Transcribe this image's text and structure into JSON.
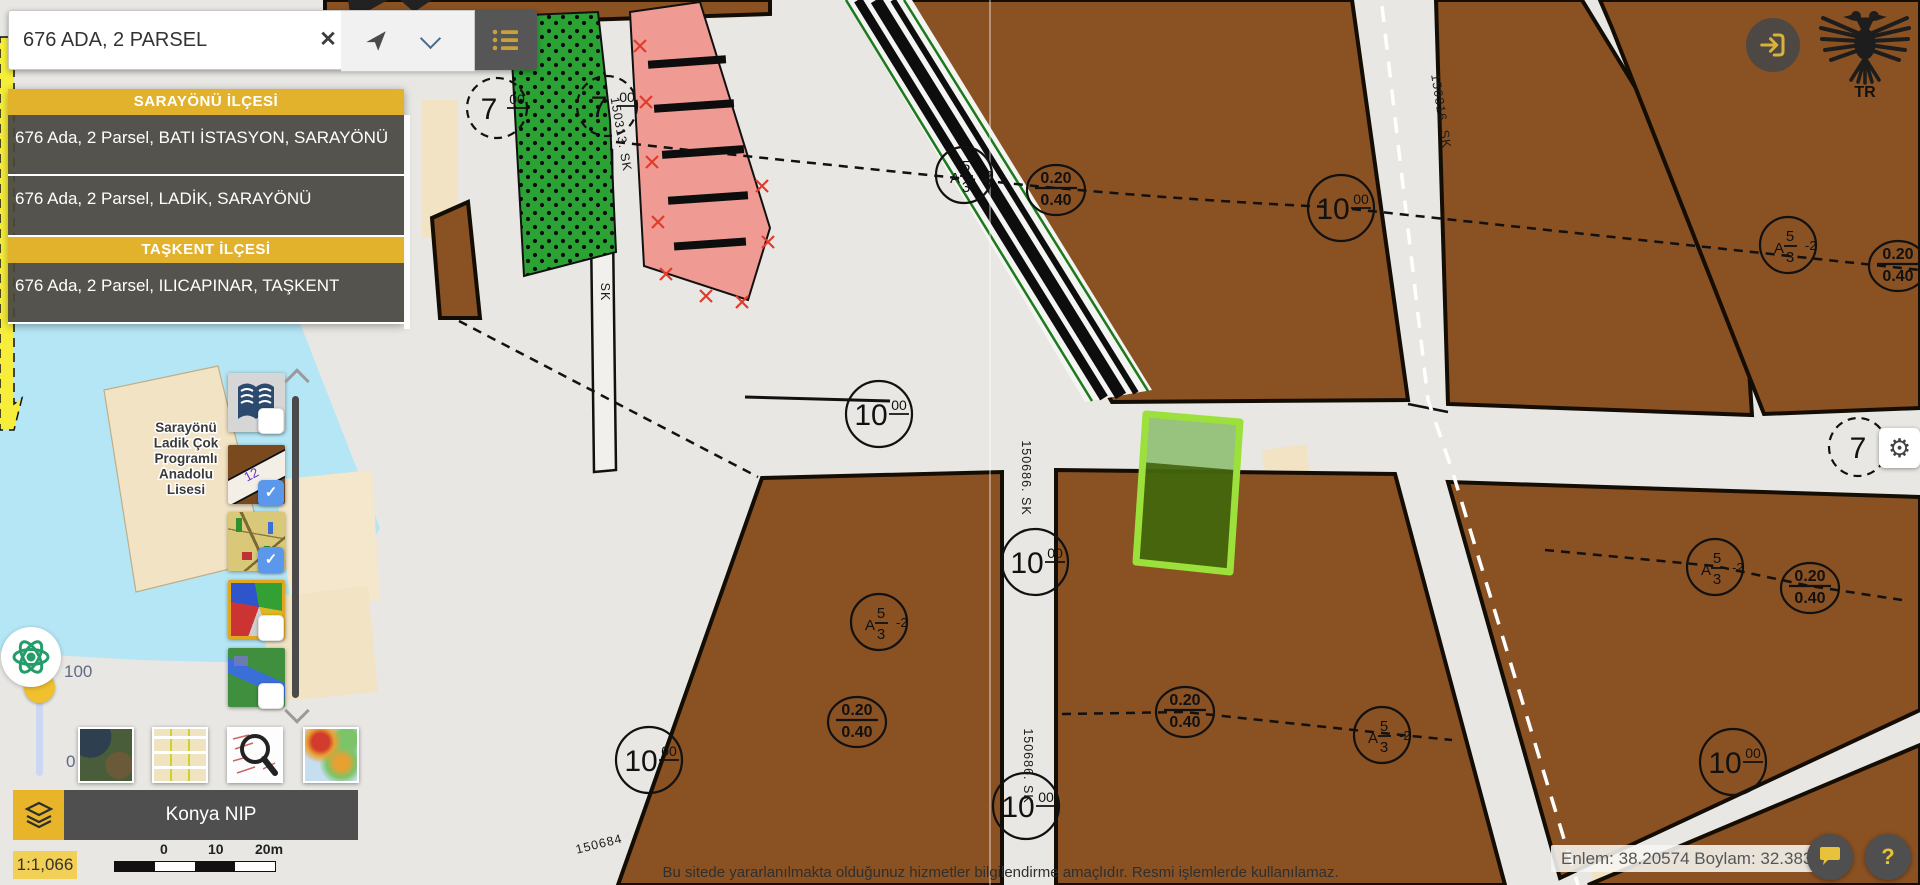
{
  "search": {
    "value": "676 ADA, 2 PARSEL",
    "results": [
      {
        "kind": "header",
        "label": "SARAYÖNÜ İLÇESİ"
      },
      {
        "kind": "item",
        "label": "676 Ada, 2 Parsel, BATI İSTASYON, SARAYÖNÜ"
      },
      {
        "kind": "item",
        "label": "676 Ada, 2 Parsel, LADİK, SARAYÖNÜ"
      },
      {
        "kind": "header",
        "label": "TAŞKENT İLÇESİ"
      },
      {
        "kind": "item",
        "label": "676 Ada, 2 Parsel, ILICAPINAR, TAŞKENT"
      }
    ]
  },
  "layers": {
    "checked": [
      false,
      true,
      true,
      false,
      false
    ]
  },
  "controls": {
    "plan_name": "Konya NIP",
    "scale_text": "1:1,066",
    "scale_ticks": [
      "0",
      "10",
      "20m"
    ],
    "coords": "Enlem: 38.20574 Boylam: 32.38381",
    "slider_max": "100",
    "slider_min": "0",
    "help_label": "?",
    "logo_text": "TR"
  },
  "footer": {
    "disclaimer": "Bu sitede yararlanılmakta olduğunuz hizmetler bilgilendirme amaçlıdır. Resmi işlemlerde kullanılamaz."
  },
  "map": {
    "school_label_lines": [
      "Sarayönü",
      "Ladik Çok",
      "Programlı",
      "Anadolu",
      "Lisesi"
    ],
    "circle_labels": [
      {
        "x": 879,
        "y": 414,
        "main": "10",
        "sup": "00"
      },
      {
        "x": 1035,
        "y": 562,
        "main": "10",
        "sup": "00"
      },
      {
        "x": 649,
        "y": 760,
        "main": "10",
        "sup": "00"
      },
      {
        "x": 1733,
        "y": 762,
        "main": "10",
        "sup": "00"
      },
      {
        "x": 1341,
        "y": 208,
        "main": "10",
        "sup": "00"
      },
      {
        "x": 1026,
        "y": 806,
        "main": "10",
        "sup": "00"
      },
      {
        "x": 497,
        "y": 108,
        "main": "7",
        "sup": "00",
        "dashed": true,
        "r": 30
      },
      {
        "x": 607,
        "y": 106,
        "main": "7",
        "sup": "00",
        "dashed": true,
        "r": 30
      },
      {
        "x": 1858,
        "y": 447,
        "main": "7",
        "sup": "",
        "dashed": true,
        "r": 29
      }
    ],
    "ratio_labels": [
      {
        "x": 1056,
        "y": 190,
        "top": "0.20",
        "bottom": "0.40"
      },
      {
        "x": 1898,
        "y": 266,
        "top": "0.20",
        "bottom": "0.40"
      },
      {
        "x": 857,
        "y": 722,
        "top": "0.20",
        "bottom": "0.40"
      },
      {
        "x": 1185,
        "y": 712,
        "top": "0.20",
        "bottom": "0.40"
      },
      {
        "x": 1810,
        "y": 588,
        "top": "0.20",
        "bottom": "0.40"
      }
    ],
    "zone_labels": [
      {
        "x": 964,
        "y": 175,
        "prefix": "A",
        "top": "5",
        "exp": "-2",
        "bottom": "3"
      },
      {
        "x": 1788,
        "y": 245,
        "prefix": "A",
        "top": "5",
        "exp": "-2",
        "bottom": "3"
      },
      {
        "x": 879,
        "y": 622,
        "prefix": "A",
        "top": "5",
        "exp": "-2",
        "bottom": "3"
      },
      {
        "x": 1382,
        "y": 735,
        "prefix": "A",
        "top": "5",
        "exp": "-2",
        "bottom": "3"
      },
      {
        "x": 1715,
        "y": 567,
        "prefix": "A",
        "top": "5",
        "exp": "-2",
        "bottom": "3"
      }
    ],
    "street_labels": [
      {
        "x": 1437,
        "y": 112,
        "rot": 81,
        "text": "150316. SK"
      },
      {
        "x": 617,
        "y": 135,
        "rot": 80,
        "text": "150313. SK"
      },
      {
        "x": 1022,
        "y": 478,
        "rot": 90,
        "text": "150686. SK"
      },
      {
        "x": 1024,
        "y": 766,
        "rot": 90,
        "text": "150686. SK"
      },
      {
        "x": 600,
        "y": 848,
        "rot": -14,
        "text": "150684"
      },
      {
        "x": 601,
        "y": 292,
        "rot": 90,
        "text": "SK"
      }
    ]
  },
  "colors": {
    "accent_gold": "#e2b22c",
    "panel_dark": "#4f4f4f",
    "checkbox_blue": "#5b97ea",
    "selection_green": "#9ade3f",
    "zone_brown": "#8a5122",
    "water_blue": "#b5e6f5"
  }
}
